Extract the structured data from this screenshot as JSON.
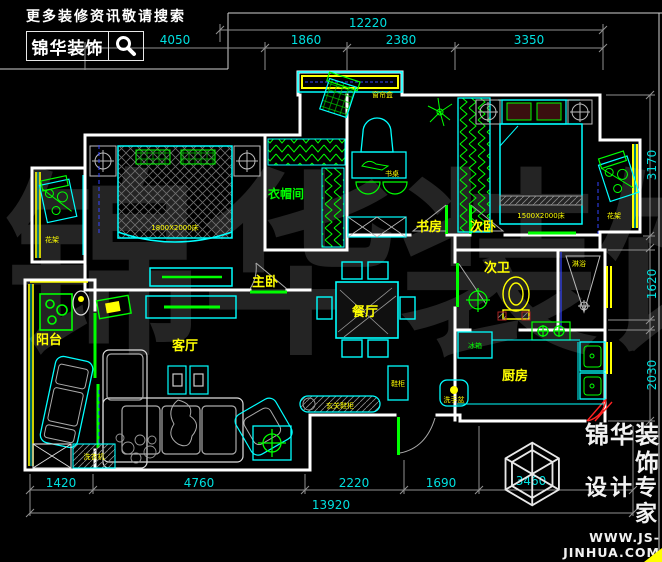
{
  "header": {
    "tagline": "更多装修资讯敬请搜索",
    "brand": "锦华装饰"
  },
  "watermark": {
    "char1": "锦",
    "char2": "华",
    "char3": "装",
    "char4": "饰"
  },
  "rooms": {
    "master": "主卧",
    "second_bedroom": "次卧",
    "study": "书房",
    "cloakroom": "衣帽间",
    "second_bath": "次卫",
    "dining": "餐厅",
    "living": "客厅",
    "balcony": "阳台",
    "kitchen": "厨房"
  },
  "furniture": {
    "bed_master": "1800X2000床",
    "bed_second": "1500X2000床",
    "desk": "书桌",
    "curtain_box": "窗帘盒",
    "plant_left": "花架",
    "plant_right": "花架",
    "shoe_cabinet": "玄关鞋柜",
    "hall_cabinet": "鞋柜",
    "basin": "洗手盆",
    "washer": "洗衣机",
    "fridge": "冰箱",
    "shower": "淋浴"
  },
  "dimensions": {
    "top_overall": "12220",
    "top_seg1": "4050",
    "top_seg2": "1860",
    "top_seg3": "2380",
    "top_seg4": "3350",
    "bottom_seg1": "1420",
    "bottom_seg2": "4760",
    "bottom_seg3": "2220",
    "bottom_seg4": "1690",
    "bottom_seg5": "3460",
    "bottom_overall": "13920",
    "right_seg1": "3170",
    "right_seg2": "1620",
    "right_seg3": "2030"
  },
  "footer": {
    "brand": "锦华装饰",
    "slogan": "设计专家",
    "website": "WWW.JS-JINHUA.COM"
  },
  "colors": {
    "background": "#000000",
    "wall": "#ffffff",
    "furniture_line": "#00ffff",
    "room_label": "#ffff00",
    "accent_green": "#00ff00",
    "dimension": "#00e0e0",
    "blue_line": "#3344ff",
    "red_line": "#ff2222"
  }
}
